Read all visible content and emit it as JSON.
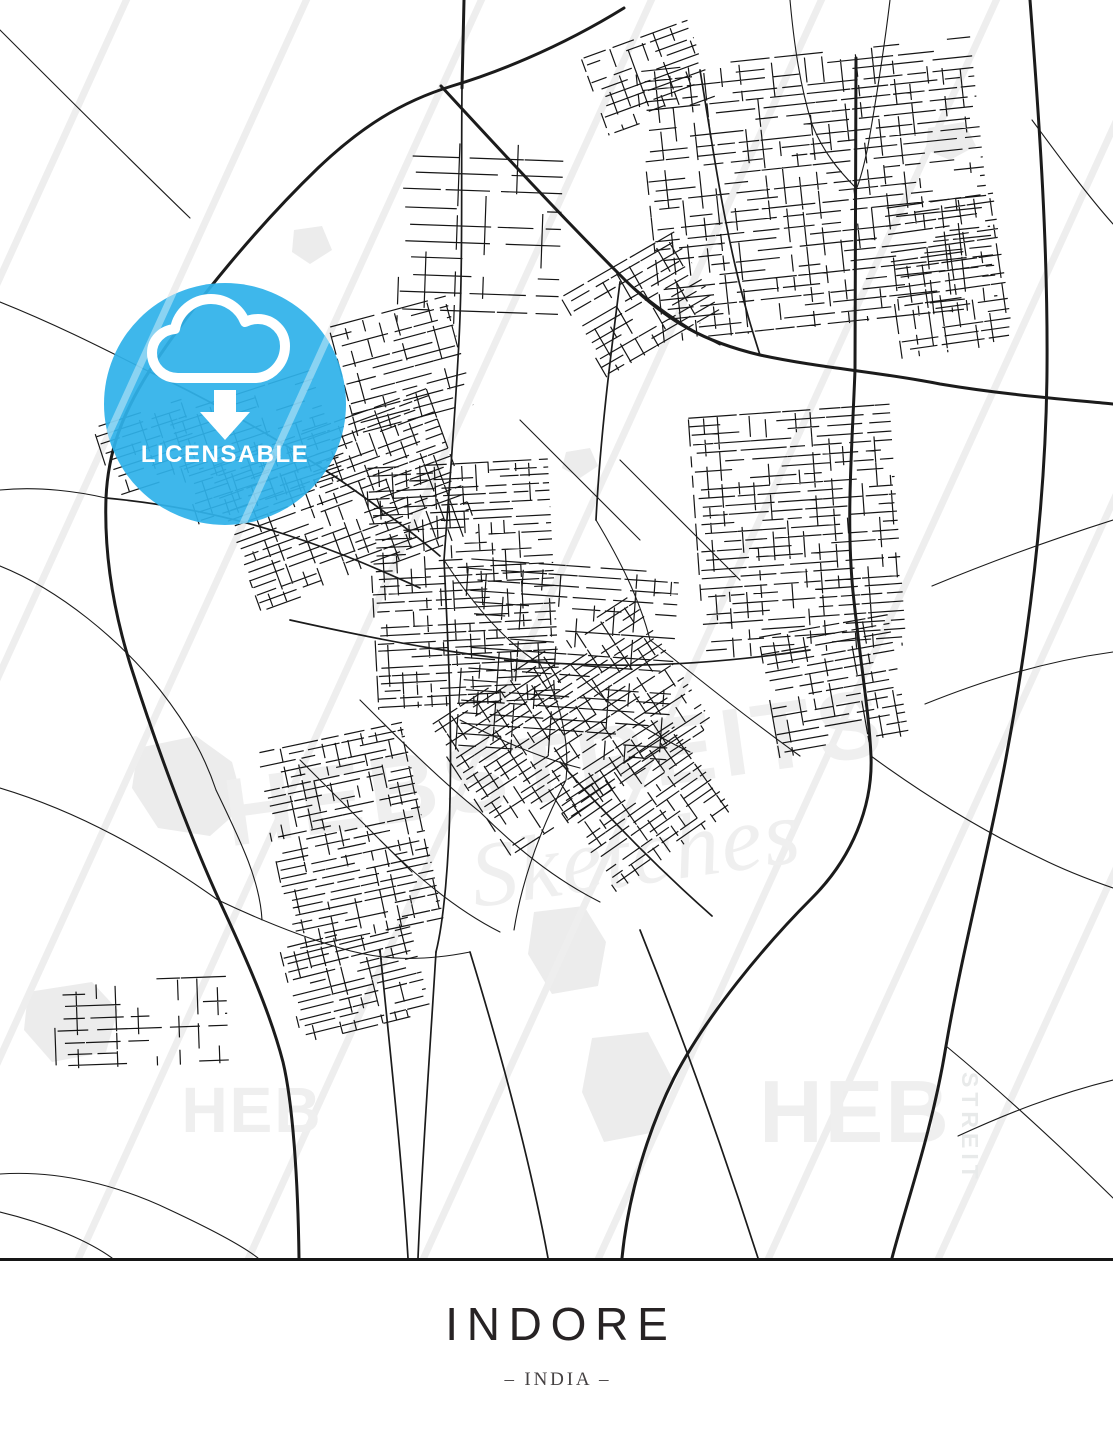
{
  "poster": {
    "title": "INDORE",
    "subtitle": "– INDIA –"
  },
  "badge": {
    "label": "LICENSABLE",
    "color": "#2fb2ea",
    "icon": "cloud-download-icon"
  },
  "watermarks": {
    "center_primary": "HEBSTREITS",
    "center_script": "Sketches",
    "heb_left": "HEB",
    "heb_right": "HEB",
    "streit_vertical": "STREIT"
  },
  "map": {
    "ink": "#1b1b1b",
    "area_fill": "#ececec",
    "watermark_gray": "#efefef",
    "areas": [
      "M138,748 L196,736 L232,762 L244,806 L210,836 L158,828 L132,788 Z",
      "M534,912 L584,906 L606,942 L598,986 L552,994 L528,954 Z",
      "M592,1038 L648,1032 L672,1078 L656,1132 L604,1142 L582,1092 Z",
      "M28,992 L92,982 L118,1010 L106,1052 L52,1062 L24,1030 Z",
      "M294,230 L322,226 L332,250 L310,264 L292,252 Z",
      "M928,128 L964,122 L976,146 L950,160 L926,150 Z",
      "M566,452 L590,448 L598,466 L580,478 L562,468 Z"
    ],
    "scratch_x0": [
      -470,
      -290,
      -115,
      55,
      225,
      400,
      575,
      745,
      915
    ],
    "major_roads": [
      "M624,8 C556,50 492,74 452,86 C400,102 360,128 318,168 C260,224 196,300 150,370 C122,414 108,452 106,498 C104,556 114,614 132,670 C155,742 188,832 220,902 C246,958 270,1012 283,1062 C293,1104 298,1182 299,1258",
      "M1030,0 C1040,130 1048,250 1047,370 C1046,500 1030,630 1006,758 C988,854 962,952 946,1046 C932,1132 906,1204 892,1258",
      "M441,86 C500,150 560,215 625,280 C668,322 705,342 760,355 C820,368 880,372 940,384 C1000,394 1050,398 1113,404",
      "M856,58 L855,370 C852,450 846,520 853,592 C861,668 869,712 871,756 C873,806 852,858 812,898 C764,946 706,1016 674,1078 C648,1130 628,1196 622,1258",
      "M464,0 L462,88"
    ],
    "medium_roads": [
      "M462,88 C461,180 463,260 459,340 C455,420 449,490 444,560",
      "M106,498 C170,504 230,516 290,536 C340,552 380,570 420,588",
      "M150,372 C210,400 280,440 340,480 C380,508 412,532 440,556",
      "M444,560 C448,640 452,720 450,800 C449,860 444,920 436,952",
      "M436,952 C430,1050 422,1160 418,1258",
      "M560,762 C610,820 660,870 712,916",
      "M290,620 C380,640 480,660 570,664 C650,668 730,662 810,650",
      "M700,70 C710,130 720,200 735,265 C745,308 752,330 760,355",
      "M620,282 C610,360 600,440 596,520",
      "M380,950 C390,1050 402,1160 408,1258",
      "M470,952 C500,1050 530,1160 548,1258",
      "M640,930 C680,1030 720,1140 758,1258"
    ],
    "minor_roads": [
      "M0,30 C60,90 125,155 190,218",
      "M0,302 C60,326 110,352 150,372",
      "M0,490 C40,486 80,492 106,498",
      "M0,566 C60,590 120,640 160,690 C190,728 206,760 216,790",
      "M0,788 C80,812 150,852 218,900",
      "M0,1174 C60,1170 120,1186 170,1210 C200,1224 240,1244 258,1258",
      "M0,1212 C50,1224 90,1242 112,1258",
      "M790,0 C794,44 800,86 812,124 C822,150 838,170 856,188",
      "M890,0 C884,50 876,100 868,146 C864,166 860,180 856,190",
      "M1032,120 C1060,158 1088,196 1113,224",
      "M1113,520 C1050,540 990,562 932,586",
      "M1113,652 C1040,662 980,682 925,704",
      "M1113,1080 C1056,1094 1006,1114 958,1136",
      "M946,1046 C1004,1094 1062,1148 1113,1198",
      "M871,756 C920,792 980,830 1040,858 C1064,870 1090,880 1113,888",
      "M444,560 C470,600 502,640 540,664",
      "M540,664 C560,700 570,740 566,780",
      "M566,780 C540,830 522,880 514,930",
      "M596,520 C620,560 640,600 650,640",
      "M650,640 C700,680 750,720 800,756",
      "M570,664 C600,700 642,730 690,752",
      "M460,720 C500,740 540,758 580,768",
      "M360,700 C400,740 440,780 480,812",
      "M480,812 C520,852 560,882 600,902",
      "M620,460 C660,500 700,540 740,580",
      "M520,420 C560,460 600,500 640,540",
      "M380,840 C420,880 460,912 500,932",
      "M300,760 C340,800 380,840 412,872",
      "M625,280 C660,310 690,330 720,345",
      "M218,900 C260,920 300,936 340,948 C380,960 420,962 470,952",
      "M216,790 C240,840 260,880 262,920"
    ],
    "clusters": [
      {
        "x": 636,
        "y": 72,
        "w": 336,
        "h": 272,
        "a": -6,
        "g": 10,
        "s": 11
      },
      {
        "x": 560,
        "y": 298,
        "w": 132,
        "h": 92,
        "a": -30,
        "g": 9,
        "s": 21
      },
      {
        "x": 402,
        "y": 138,
        "w": 162,
        "h": 184,
        "a": 2,
        "g": 17,
        "s": 31
      },
      {
        "x": 882,
        "y": 208,
        "w": 112,
        "h": 152,
        "a": -8,
        "g": 9,
        "s": 41
      },
      {
        "x": 166,
        "y": 418,
        "w": 152,
        "h": 112,
        "a": -18,
        "g": 9,
        "s": 51
      },
      {
        "x": 208,
        "y": 468,
        "w": 232,
        "h": 152,
        "a": -20,
        "g": 8,
        "s": 61
      },
      {
        "x": 366,
        "y": 468,
        "w": 182,
        "h": 242,
        "a": -3,
        "g": 8,
        "s": 71
      },
      {
        "x": 468,
        "y": 558,
        "w": 212,
        "h": 192,
        "a": 4,
        "g": 11,
        "s": 81
      },
      {
        "x": 688,
        "y": 418,
        "w": 202,
        "h": 242,
        "a": -4,
        "g": 9,
        "s": 91
      },
      {
        "x": 428,
        "y": 728,
        "w": 242,
        "h": 152,
        "a": -33,
        "g": 8,
        "s": 101
      },
      {
        "x": 253,
        "y": 753,
        "w": 152,
        "h": 202,
        "a": -12,
        "g": 8,
        "s": 111
      },
      {
        "x": 280,
        "y": 950,
        "w": 132,
        "h": 96,
        "a": -14,
        "g": 8,
        "s": 121
      },
      {
        "x": 54,
        "y": 983,
        "w": 172,
        "h": 86,
        "a": -2,
        "g": 12,
        "s": 131
      },
      {
        "x": 582,
        "y": 58,
        "w": 112,
        "h": 82,
        "a": -20,
        "g": 9,
        "s": 141
      },
      {
        "x": 758,
        "y": 638,
        "w": 132,
        "h": 122,
        "a": -10,
        "g": 9,
        "s": 151
      },
      {
        "x": 328,
        "y": 328,
        "w": 122,
        "h": 112,
        "a": -15,
        "g": 10,
        "s": 161
      },
      {
        "x": 558,
        "y": 808,
        "w": 142,
        "h": 102,
        "a": -35,
        "g": 8,
        "s": 171
      },
      {
        "x": 94,
        "y": 428,
        "w": 92,
        "h": 72,
        "a": -18,
        "g": 9,
        "s": 181
      }
    ]
  }
}
